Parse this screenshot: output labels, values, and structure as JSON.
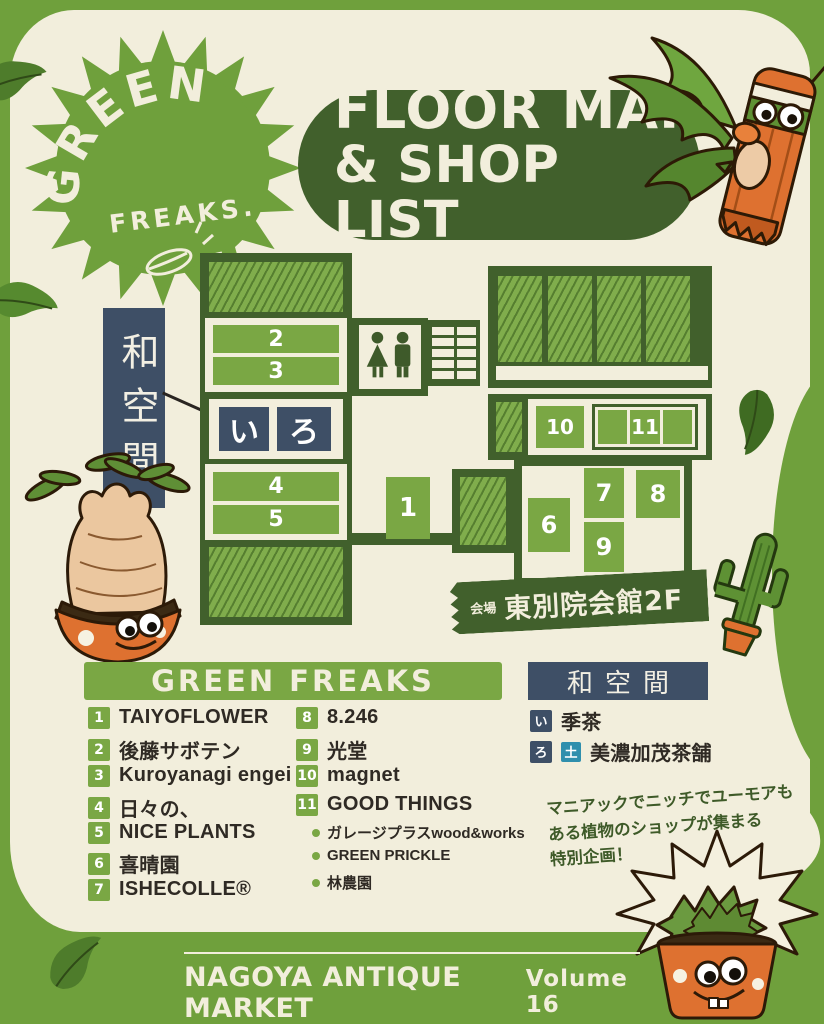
{
  "colors": {
    "background_green": "#6FA03C",
    "cream": "#F2EEDC",
    "dark_green": "#41602C",
    "booth_green": "#7AA744",
    "navy": "#3E4F66",
    "day_badge_teal": "#2F8FAD",
    "pot_orange": "#DE7130",
    "text_ink": "#2F2A24"
  },
  "logo": {
    "top": "GREEN",
    "bottom": "FREAKS."
  },
  "title": {
    "line1": "FLOOR MAP",
    "line2": "& SHOP LIST"
  },
  "map": {
    "wa_space_label": "和空間",
    "booths": {
      "n1": "1",
      "n2": "2",
      "n3": "3",
      "n4": "4",
      "n5": "5",
      "n6": "6",
      "n7": "7",
      "n8": "8",
      "n9": "9",
      "n10": "10",
      "n11": "11"
    },
    "tatami": {
      "i": "い",
      "ro": "ろ"
    },
    "venue": {
      "label": "会場",
      "name": "東別院会館2F"
    }
  },
  "shop_list": {
    "green_freaks": {
      "title": "GREEN FREAKS",
      "items": [
        {
          "num": "1",
          "name": "TAIYOFLOWER"
        },
        {
          "num": "2",
          "name": "後藤サボテン"
        },
        {
          "num": "3",
          "name": "Kuroyanagi engei"
        },
        {
          "num": "4",
          "name": "日々の、"
        },
        {
          "num": "5",
          "name": "NICE PLANTS"
        },
        {
          "num": "6",
          "name": "喜晴園"
        },
        {
          "num": "7",
          "name": "ISHECOLLE®"
        },
        {
          "num": "8",
          "name": "8.246"
        },
        {
          "num": "9",
          "name": "光堂"
        },
        {
          "num": "10",
          "name": "magnet"
        },
        {
          "num": "11",
          "name": "GOOD THINGS"
        }
      ],
      "good_things_subshops": [
        "ガレージプラスwood&works",
        "GREEN PRICKLE",
        "林農園"
      ]
    },
    "wa_space": {
      "title": "和空間",
      "items": [
        {
          "badge": "い",
          "name": "季茶"
        },
        {
          "badge": "ろ",
          "day": "土",
          "name": "美濃加茂茶舗"
        }
      ]
    }
  },
  "note": {
    "line1": "マニアックでニッチでユーモアも",
    "line2": "ある植物のショップが集まる",
    "line3": "特別企画！"
  },
  "footer": {
    "market": "NAGOYA ANTIQUE MARKET",
    "volume": "Volume 16"
  }
}
